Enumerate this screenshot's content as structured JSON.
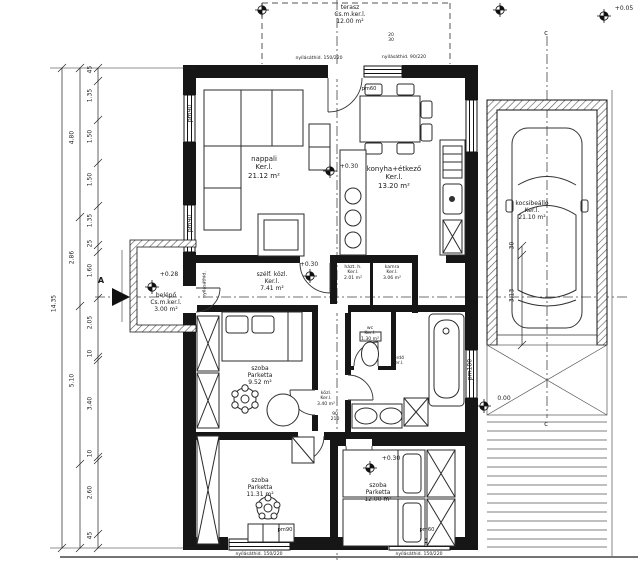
{
  "drawing": {
    "type": "architectural floor plan (ground floor, Hungarian)"
  },
  "rooms": {
    "terasz": {
      "name": "terasz",
      "floor": "Cs.m.ker.l.",
      "area": "12.00 m²"
    },
    "nappali": {
      "name": "nappali",
      "floor": "Ker.l.",
      "area": "21.12 m²"
    },
    "konyha": {
      "name": "konyha+étkező",
      "floor": "Ker.l.",
      "area": "13.20 m²"
    },
    "szelfogo": {
      "name": "szélf. közl.",
      "floor": "Ker.l.",
      "area": "7.41 m²"
    },
    "haztartasi": {
      "name": "házt. h.",
      "floor": "Ker.l.",
      "area": "2.01 m²"
    },
    "kamra": {
      "name": "kamra",
      "floor": "Ker.l.",
      "area": "3.06 m²"
    },
    "wc": {
      "name": "wc",
      "floor": "Ker.l.",
      "area": "1.30 m²"
    },
    "furdo": {
      "name": "fürdő",
      "floor": "Ker.l."
    },
    "szoba1": {
      "name": "szoba",
      "floor": "Parketta",
      "area": "9.52 m²"
    },
    "kozlekedo": {
      "name": "közl.",
      "floor": "Ker.l.",
      "area": "3.40 m²"
    },
    "szoba2": {
      "name": "szoba",
      "floor": "Parketta",
      "area": "11.31 m²"
    },
    "szoba3": {
      "name": "szoba",
      "floor": "Parketta",
      "area": "12.00 m²"
    },
    "belepo": {
      "name": "belépő",
      "floor": "Cs.m.ker.l.",
      "area": "3.00 m²"
    },
    "kocsibeallo": {
      "name": "kocsibeálló",
      "floor": "Ker.l.",
      "area": "21.10 m²"
    }
  },
  "elevations": {
    "terrace_right": "+0.05",
    "nappali": "+0.30",
    "szelfogo": "+0.30",
    "belepo": "+0.28",
    "szoba3": "+0.30",
    "garage_side": "0.00"
  },
  "sections": {
    "a": "A",
    "c_top": "c",
    "c_bottom": "c"
  },
  "dims": {
    "overall": "14.35",
    "left_outer": [
      "4.80",
      "2.86",
      "5.10"
    ],
    "left_inner": [
      "45",
      "1.35",
      "1.50",
      "1.50",
      "1.35",
      "25",
      "1.60",
      "2.05",
      "10",
      "3.40",
      "10",
      "2.60",
      "45"
    ],
    "garage": [
      "30",
      "3.13"
    ],
    "door_width": "90",
    "door_height": "210",
    "top_small": [
      "20",
      "30"
    ]
  },
  "openings": {
    "lintel_top_1": "nyílásáthid. 150/220",
    "lintel_top_2": "nyílásáthid. 90/220",
    "lintel_bottom_1": "nyílásáthid. 150/220",
    "lintel_bottom_2": "nyílásáthid. 150/220",
    "lintel_entry": "nyílásáthid.",
    "pm90_left_1": "pm90",
    "pm90_left_2": "pm90",
    "pm90_bottom": "pm90",
    "pm60_bottom": "pm60",
    "pm60_top": "pm60",
    "pm180_bath": "pm180"
  },
  "colors": {
    "line": "#1a1a1a",
    "wall_fill": "#161616",
    "background": "#ffffff"
  }
}
